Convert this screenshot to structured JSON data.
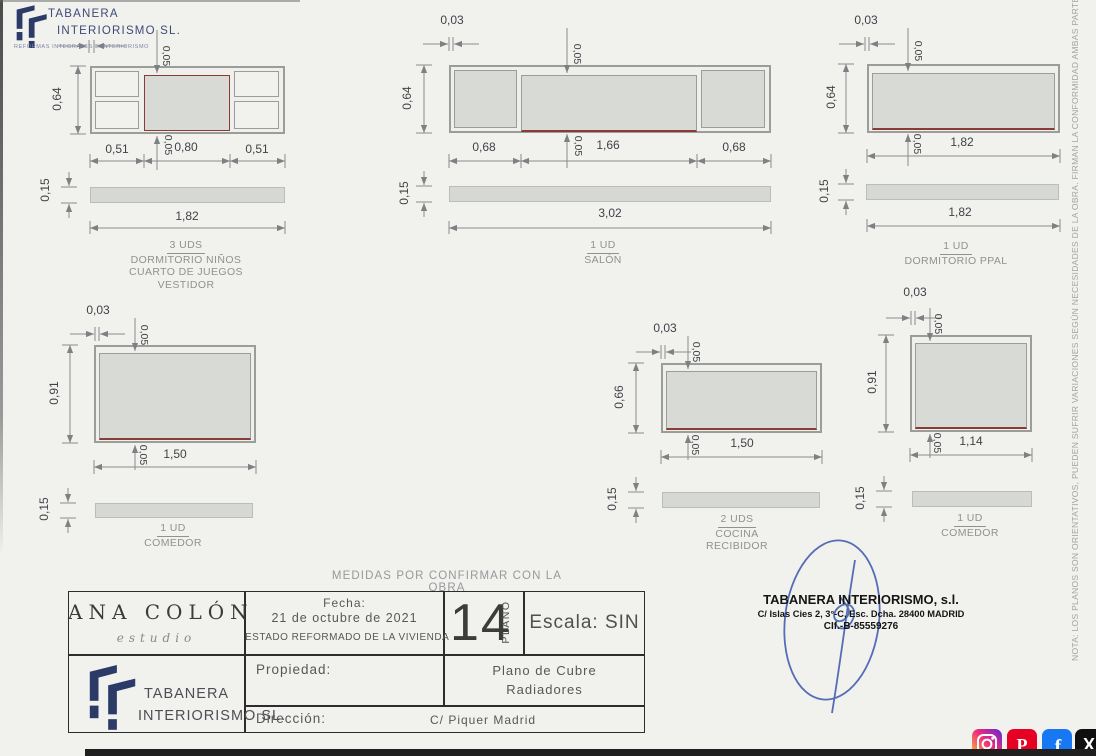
{
  "page": {
    "banner": "MEDIDAS POR CONFIRMAR CON LA OBRA",
    "side_note": "NOTA: LOS PLANOS SON ORIENTATIVOS,  PUEDEN SUFRIR VARIACIONES  SEGÚN NECESIDADES  DE LA OBRA. FIRMAN  LA CONFORMIDAD  AMBAS PARTES"
  },
  "logo": {
    "name_line1": "TABANERA",
    "name_line2": "INTERIORISMO SL.",
    "tagline": "REFORMAS INTEGRALES E INTERIORISMO"
  },
  "drawings": {
    "d1": {
      "top_offset": "0,05",
      "bottom_offset": "0,05",
      "height": "0,64",
      "width_left": "0,51",
      "width_center": "0,80",
      "width_right": "0,51",
      "shelf_thickness": "0,15",
      "shelf_width": "1,82",
      "units": "3 UDS",
      "room_1": "DORMITORIO NIÑOS",
      "room_2": "CUARTO DE JUEGOS",
      "room_3": "VESTIDOR"
    },
    "d2": {
      "gap": "0,03",
      "top_offset": "0,05",
      "bottom_offset": "0,05",
      "height": "0,64",
      "width_left": "0,68",
      "width_center": "1,66",
      "width_right": "0,68",
      "shelf_thickness": "0,15",
      "shelf_width": "3,02",
      "units": "1 UD",
      "room_1": "SALÓN"
    },
    "d3": {
      "gap": "0,03",
      "top_offset": "0,05",
      "bottom_offset": "0,05",
      "height": "0,64",
      "width": "1,82",
      "shelf_thickness": "0,15",
      "shelf_width": "1,82",
      "units": "1 UD",
      "room_1": "DORMITORIO PPAL"
    },
    "d4": {
      "gap": "0,03",
      "top_offset": "0,05",
      "bottom_offset": "0,05",
      "height": "0,91",
      "width": "1,50",
      "shelf_thickness": "0,15",
      "units": "1 UD",
      "room_1": "COMEDOR"
    },
    "d5": {
      "gap": "0,03",
      "top_offset": "0,05",
      "bottom_offset": "0,05",
      "height": "0,66",
      "width": "1,50",
      "shelf_thickness": "0,15",
      "units": "2 UDS",
      "room_1": "COCINA",
      "room_2": "RECIBIDOR"
    },
    "d6": {
      "gap": "0,03",
      "top_offset": "0,05",
      "bottom_offset": "0,05",
      "height": "0,91",
      "width": "1,14",
      "shelf_thickness": "0,15",
      "units": "1 UD",
      "room_1": "COMEDOR"
    }
  },
  "titleblock": {
    "studio_name": "ANA COLÓN",
    "studio_subtitle": "estudio",
    "fecha_label": "Fecha:",
    "fecha_value": "21 de octubre de 2021",
    "estado": "ESTADO REFORMADO DE LA VIVIENDA",
    "plano_number": "14",
    "plano_label": "PLANO",
    "escala_label": "Escala:",
    "escala_value": "SIN",
    "propiedad_label": "Propiedad:",
    "plano_title_line1": "Plano de Cubre",
    "plano_title_line2": "Radiadores",
    "direccion_label": "Dirección:",
    "direccion_value": "C/ Piquer  Madrid",
    "firm_line1": "TABANERA",
    "firm_line2": "INTERIORISMO SL."
  },
  "stamp": {
    "line1": "TABANERA INTERIORISMO, s.l.",
    "line2": "C/ Islas Cies 2, 3°-C, Esc. Dcha. 28400 MADRID",
    "line3": "CIf.-B-85559276"
  },
  "social": {
    "instagram": "instagram",
    "pinterest": "pinterest",
    "facebook": "facebook",
    "x": "x"
  },
  "colors": {
    "accent_red": "#8b3a36",
    "line_gray": "#9a9d99",
    "navy": "#2c3a68",
    "signature_blue": "#3a56ad"
  }
}
